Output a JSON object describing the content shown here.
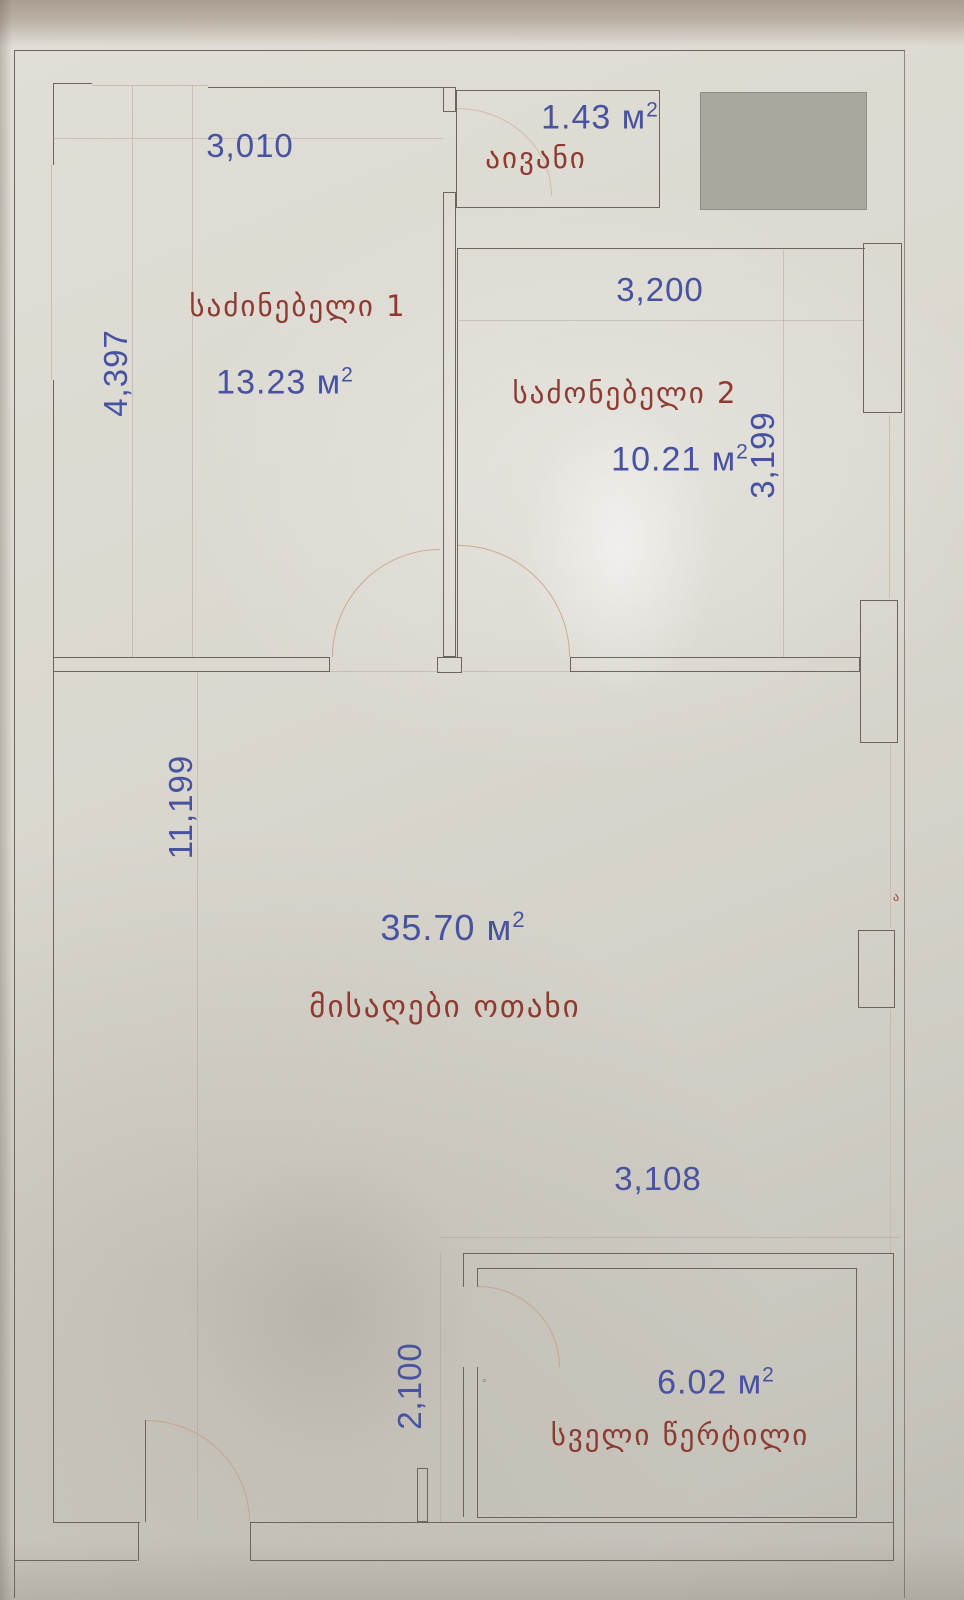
{
  "colors": {
    "ink": "#6b665c",
    "dim_blue": "#4753a0",
    "room_red": "#8e3a30",
    "door_arc": "#c79e85",
    "gray_block": "#a9a89e"
  },
  "rooms": [
    {
      "key": "balcony",
      "name": "აივანი",
      "area": "1.43 м",
      "area_sup": "2"
    },
    {
      "key": "bedroom-1",
      "name": "საძინებელი 1",
      "area": "13.23 м",
      "area_sup": "2"
    },
    {
      "key": "bedroom-2",
      "name": "საძონებელი 2",
      "area": "10.21 м",
      "area_sup": "2"
    },
    {
      "key": "living-room",
      "name": "მისაღები ოთახი",
      "area": "35.70 м",
      "area_sup": "2"
    },
    {
      "key": "bathroom",
      "name": "სველი წერტილი",
      "area": "6.02 м",
      "area_sup": "2"
    }
  ],
  "dimensions": {
    "bedroom1_width": "3,010",
    "bedroom1_height": "4,397",
    "bedroom2_width": "3,200",
    "bedroom2_height": "3,199",
    "living_height": "11,199",
    "bathroom_width": "3,108",
    "bathroom_height": "2,100"
  },
  "stray_mark": "ა"
}
